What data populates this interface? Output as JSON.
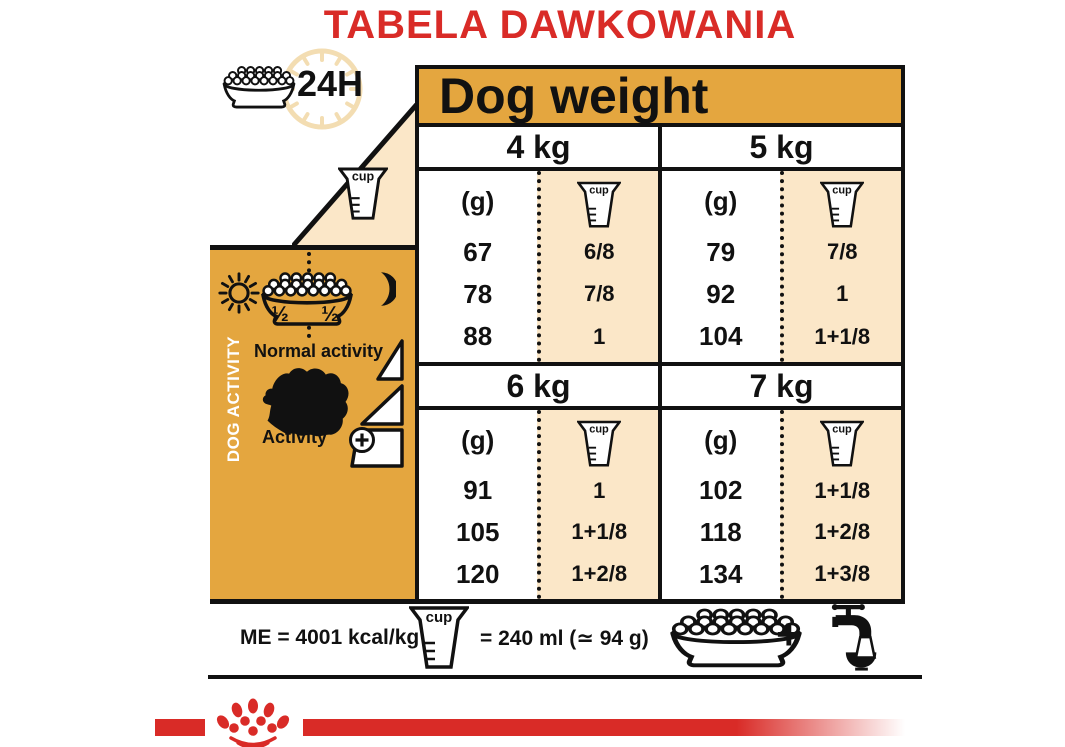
{
  "title": "TABELA DAWKOWANIA",
  "legend": {
    "hours_label": "24H"
  },
  "icons": {
    "cup_label": "cup"
  },
  "table": {
    "header": "Dog weight",
    "unit_label": "(g)",
    "quadrants": [
      {
        "weight": "4 kg",
        "rows": [
          {
            "g": "67",
            "cups": "6/8"
          },
          {
            "g": "78",
            "cups": "7/8"
          },
          {
            "g": "88",
            "cups": "1"
          }
        ]
      },
      {
        "weight": "5 kg",
        "rows": [
          {
            "g": "79",
            "cups": "7/8"
          },
          {
            "g": "92",
            "cups": "1"
          },
          {
            "g": "104",
            "cups": "1+1/8"
          }
        ]
      },
      {
        "weight": "6 kg",
        "rows": [
          {
            "g": "91",
            "cups": "1"
          },
          {
            "g": "105",
            "cups": "1+1/8"
          },
          {
            "g": "120",
            "cups": "1+2/8"
          }
        ]
      },
      {
        "weight": "7 kg",
        "rows": [
          {
            "g": "102",
            "cups": "1+1/8"
          },
          {
            "g": "118",
            "cups": "1+2/8"
          },
          {
            "g": "134",
            "cups": "1+3/8"
          }
        ]
      }
    ]
  },
  "sidebar": {
    "title": "DOG ACTIVITY",
    "bowl_half_left": "½",
    "bowl_half_right": "½",
    "normal_activity_label": "Normal activity",
    "activity_label": "Activity"
  },
  "footer": {
    "energy_label": "ME = 4001 kcal/kg",
    "cup_equivalence": "= 240 ml (≃ 94 g)",
    "plus_sign": "+"
  },
  "colors": {
    "brand_red": "#d92b27",
    "gold": "#e4a63f",
    "peach": "#fbe7c8",
    "line_black": "#111111"
  },
  "chart_data": {
    "type": "table",
    "title": "TABELA DAWKOWANIA",
    "header": "Dog weight",
    "columns_per_weight": [
      "(g)",
      "cup"
    ],
    "weights": [
      "4 kg",
      "5 kg",
      "6 kg",
      "7 kg"
    ],
    "rows_by_weight": {
      "4 kg": [
        [
          "67",
          "6/8"
        ],
        [
          "78",
          "7/8"
        ],
        [
          "88",
          "1"
        ]
      ],
      "5 kg": [
        [
          "79",
          "7/8"
        ],
        [
          "92",
          "1"
        ],
        [
          "104",
          "1+1/8"
        ]
      ],
      "6 kg": [
        [
          "91",
          "1"
        ],
        [
          "105",
          "1+1/8"
        ],
        [
          "120",
          "1+2/8"
        ]
      ],
      "7 kg": [
        [
          "102",
          "1+1/8"
        ],
        [
          "118",
          "1+2/8"
        ],
        [
          "134",
          "1+3/8"
        ]
      ]
    },
    "activity_rows": [
      "Normal activity",
      "Activity +"
    ],
    "notes": [
      "ME = 4001 kcal/kg",
      "cup = 240 ml (≃ 94 g)",
      "24H",
      "1/2 + 1/2 daily split"
    ]
  }
}
